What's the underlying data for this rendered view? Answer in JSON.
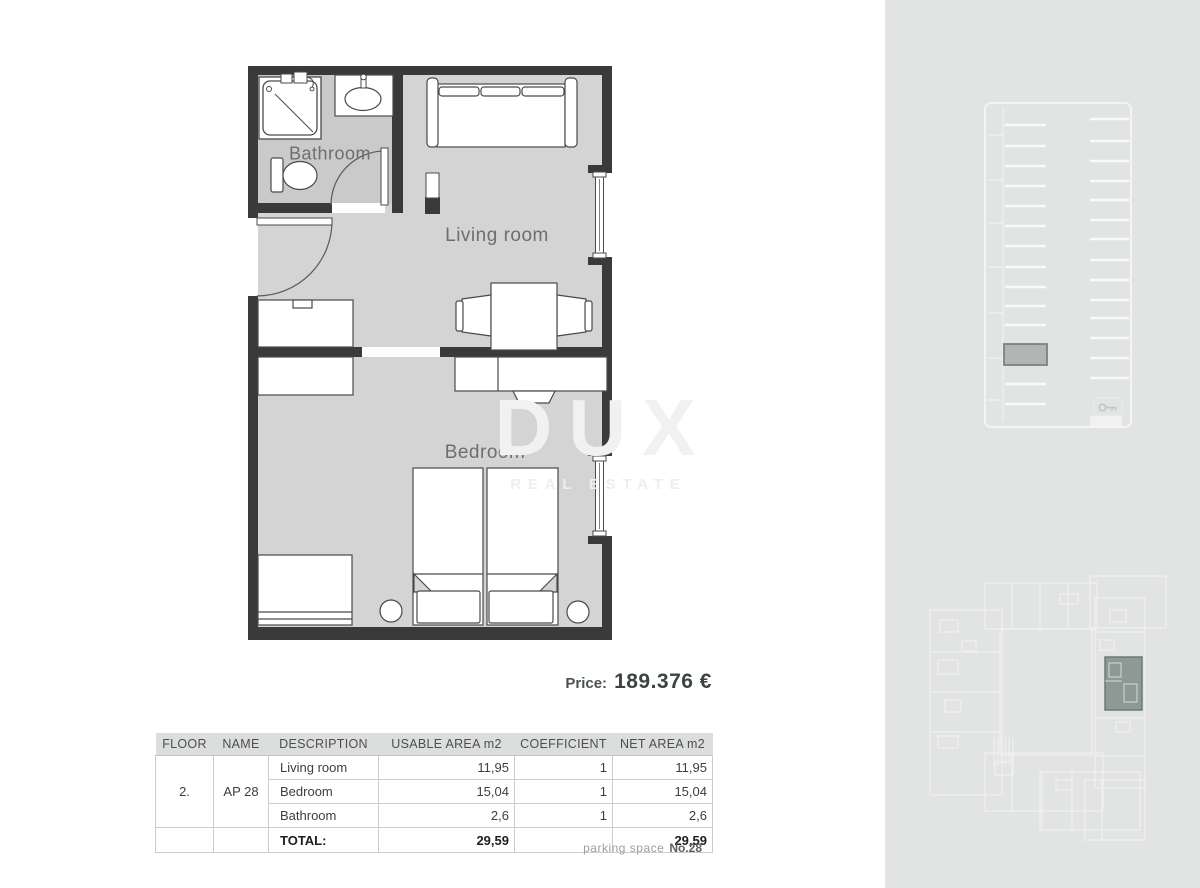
{
  "floor_plan": {
    "room_labels": {
      "bathroom": "Bathroom",
      "living_room": "Living room",
      "bedroom": "Bedroom"
    }
  },
  "watermark": {
    "title": "DUX",
    "subtitle": "REAL ESTATE"
  },
  "price": {
    "label": "Price:",
    "value": "189.376 €"
  },
  "area_table": {
    "headers": [
      "FLOOR",
      "NAME",
      "DESCRIPTION",
      "USABLE AREA m2",
      "COEFFICIENT",
      "NET AREA m2"
    ],
    "floor": "2.",
    "name": "AP 28",
    "rows": [
      {
        "description": "Living room",
        "usable_area": "11,95",
        "coefficient": "1",
        "net_area": "11,95"
      },
      {
        "description": "Bedroom",
        "usable_area": "15,04",
        "coefficient": "1",
        "net_area": "15,04"
      },
      {
        "description": "Bathroom",
        "usable_area": "2,6",
        "coefficient": "1",
        "net_area": "2,6"
      }
    ],
    "total": {
      "label": "TOTAL:",
      "usable_area": "29,59",
      "net_area": "29,59"
    }
  },
  "parking_note": {
    "label": "parking space",
    "number": "No.28"
  },
  "colors": {
    "wall": "#3a3a3a",
    "floor": "#d3d4d3",
    "bathroom_floor": "#c9cac9",
    "panel_background": "#e2e4e3",
    "parking_highlight": "#b2b5b4",
    "unit_highlight": "#8d9995"
  }
}
